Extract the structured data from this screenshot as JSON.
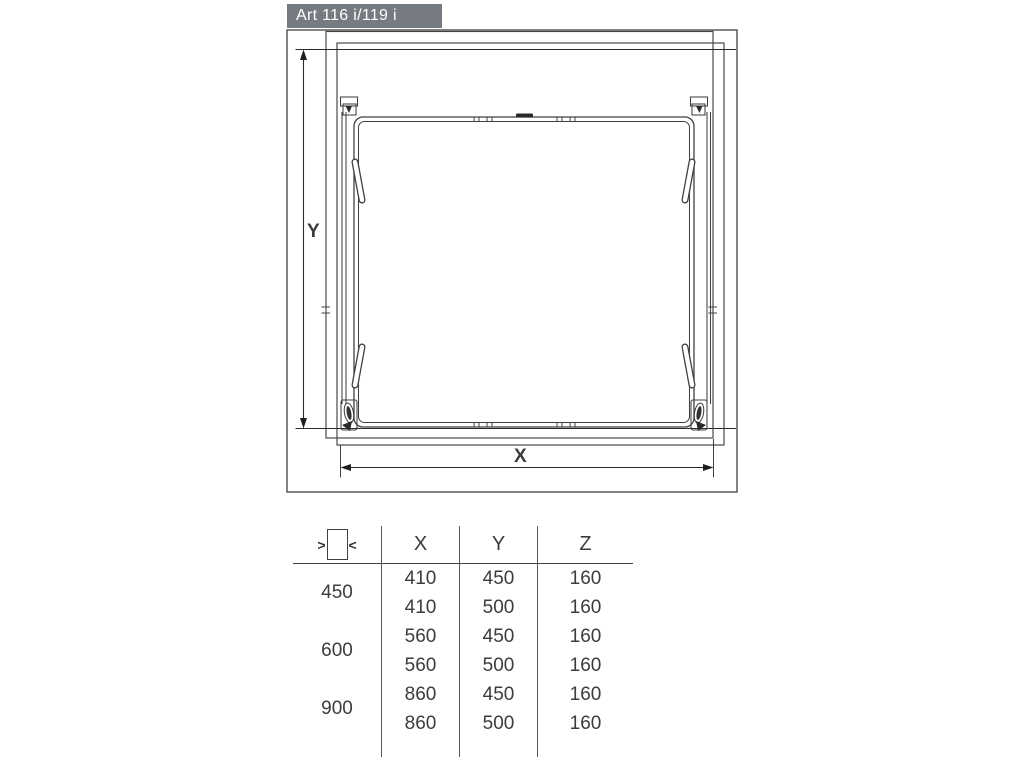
{
  "title": "Art 116 i/119 i",
  "diagram": {
    "y_label": "Y",
    "x_label": "X"
  },
  "table": {
    "width_symbol": {
      "left_arrow": ">",
      "right_arrow": "<"
    },
    "headers": [
      "X",
      "Y",
      "Z"
    ],
    "groups": [
      {
        "label": "450",
        "rows": [
          [
            "410",
            "450",
            "160"
          ],
          [
            "410",
            "500",
            "160"
          ]
        ]
      },
      {
        "label": "600",
        "rows": [
          [
            "560",
            "450",
            "160"
          ],
          [
            "560",
            "500",
            "160"
          ]
        ]
      },
      {
        "label": "900",
        "rows": [
          [
            "860",
            "450",
            "160"
          ],
          [
            "860",
            "500",
            "160"
          ]
        ]
      }
    ]
  },
  "colors": {
    "title_bg": "#767b81",
    "title_text": "#ffffff",
    "line": "#414141",
    "dim_line": "#2b2b2b",
    "text": "#3c3c3c"
  }
}
